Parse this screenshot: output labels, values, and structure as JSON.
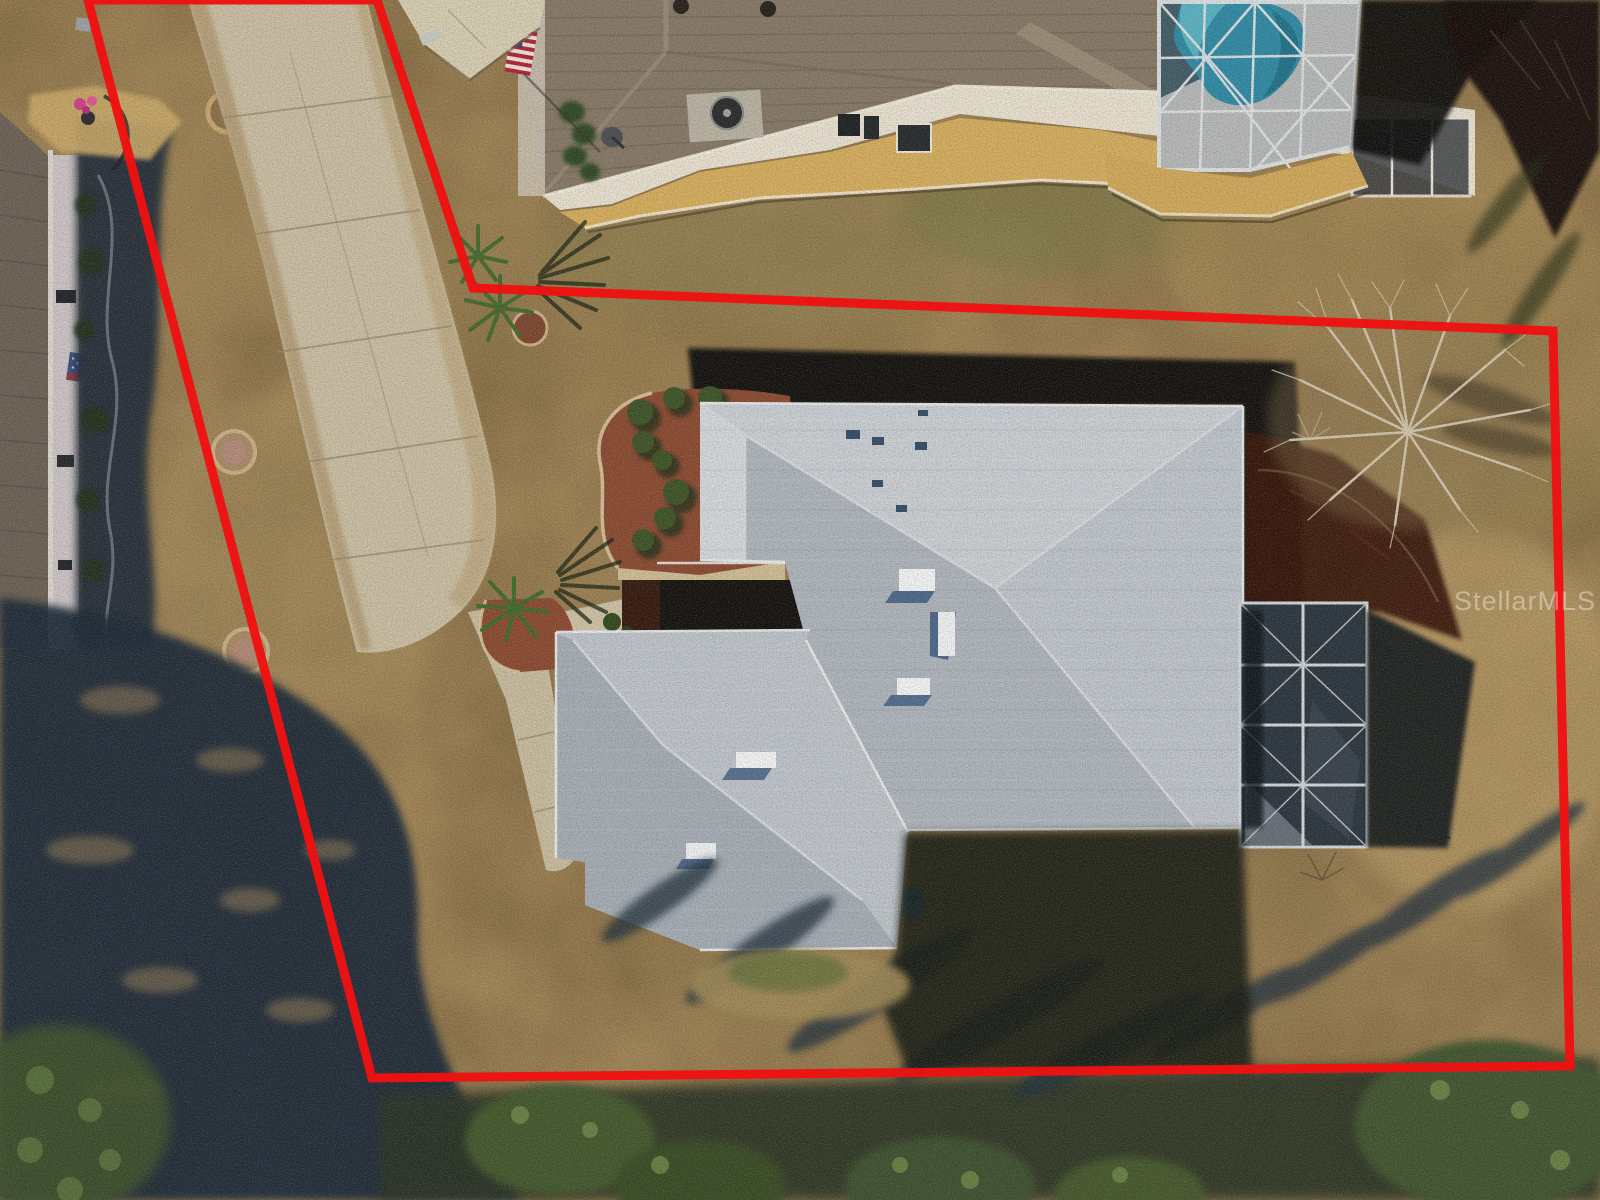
{
  "scene": {
    "kind": "aerial-drone-real-estate-photo",
    "description": "Top-down aerial photo of a single-family home with gray hip roof, screened lanai, long concrete driveway, dormant tan lawn, neighboring homes (one with screened swimming pool), trees and tree shadows, with a red property-boundary outline drawn over the photo."
  },
  "watermark": {
    "text": "StellarMLS",
    "color": "rgba(255,255,255,0.38)"
  },
  "boundary": {
    "points": "88,0 377,0 473,288 1553,331 1570,1066 372,1078",
    "color": "#ee1212",
    "stroke_width": 9
  },
  "palette": {
    "grass_base": "#a08457",
    "grass_dark": "#8a7046",
    "grass_light": "#c0a26b",
    "grass_green": "#7b7848",
    "shadow_navy": "#1d2b3a",
    "tree_green": "#42582f",
    "canopy_light": "#6f8a4a",
    "roof_light": "#c9ced5",
    "roof_medium": "#adb4bd",
    "roof_dark": "#9ba3ad",
    "ridge_white": "#e9ecef",
    "driveway": "#c9bea4",
    "sidewalk": "#c6bb9f",
    "mulch_red": "#8a4a33",
    "mulch_shaded": "#39180f",
    "pool_blue": "#2f8aa6",
    "pool_light": "#64bccb",
    "deck_gray": "#b5b8ba",
    "cage_frame": "#dfe3e5",
    "neighbor_roof": "#857868",
    "neighbor_wall": "#e7e0d1",
    "gravel_gold": "#d4ad5f",
    "flag_red": "#b22234",
    "flag_blue": "#3c3b6e",
    "night_shadow": "#0d0b07"
  }
}
